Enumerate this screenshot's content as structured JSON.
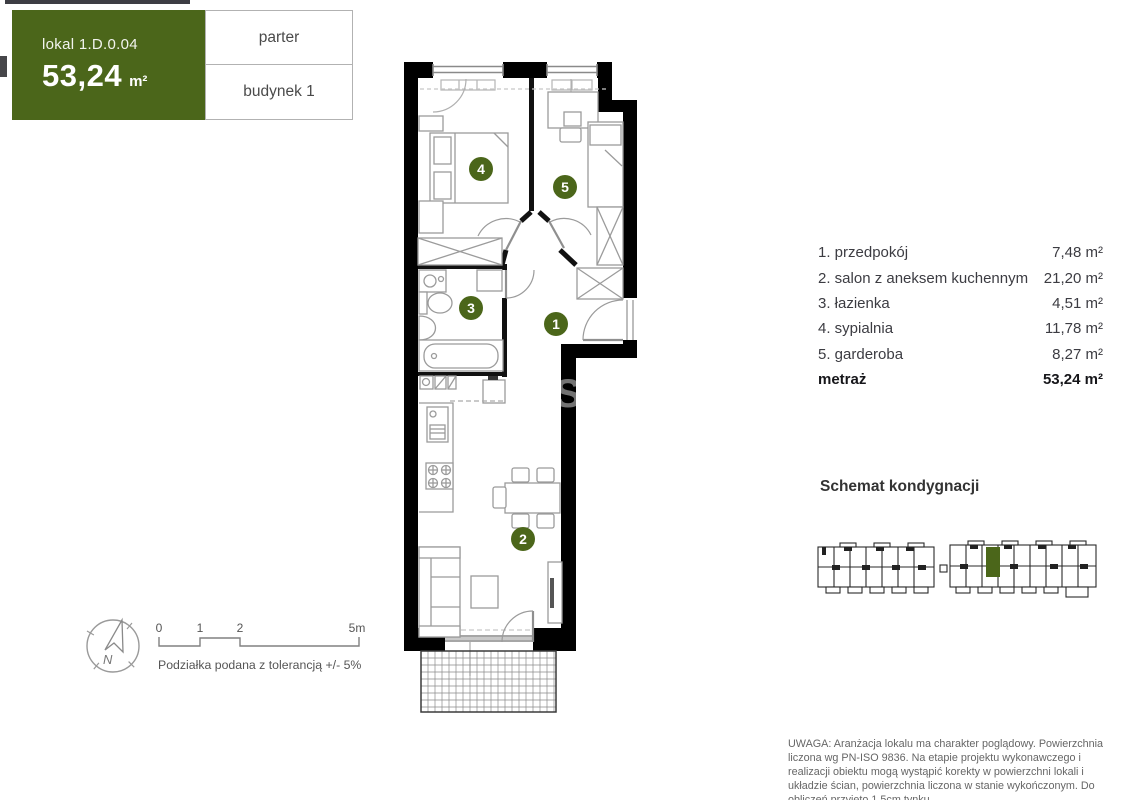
{
  "header": {
    "unit_label": "lokal 1.D.0.04",
    "area_value": "53,24",
    "area_unit": "m²",
    "floor_label": "parter",
    "building_label": "budynek 1"
  },
  "legend": {
    "rows": [
      {
        "name": "1. przedpokój",
        "area": "7,48 m²"
      },
      {
        "name": "2. salon z aneksem kuchennym",
        "area": "21,20 m²"
      },
      {
        "name": "3. łazienka",
        "area": "4,51 m²"
      },
      {
        "name": "4. sypialnia",
        "area": "11,78 m²"
      },
      {
        "name": "5. garderoba",
        "area": "8,27 m²"
      }
    ],
    "total_label": "metraż",
    "total_area": "53,24 m²"
  },
  "plan": {
    "room_numbers": [
      "1",
      "2",
      "3",
      "4",
      "5"
    ],
    "watermark": "S"
  },
  "floor_schematic": {
    "title": "Schemat kondygnacji"
  },
  "scale_bar": {
    "labels": [
      "0",
      "1",
      "2",
      "5m"
    ],
    "caption": "Podziałka podana z tolerancją +/- 5%"
  },
  "compass": {
    "north_label": "N"
  },
  "disclaimer": "UWAGA: Aranżacja lokalu ma charakter poglądowy. Powierzchnia liczona wg PN-ISO 9836. Na etapie projektu wykonawczego i realizacji obiektu mogą wystąpić korekty w powierzchni lokali i układzie ścian, powierzchnia liczona w stanie wykończonym. Do obliczeń przyjęto 1,5cm tynku.",
  "colors": {
    "accent_green": "#4b661a",
    "wall": "#000000"
  }
}
